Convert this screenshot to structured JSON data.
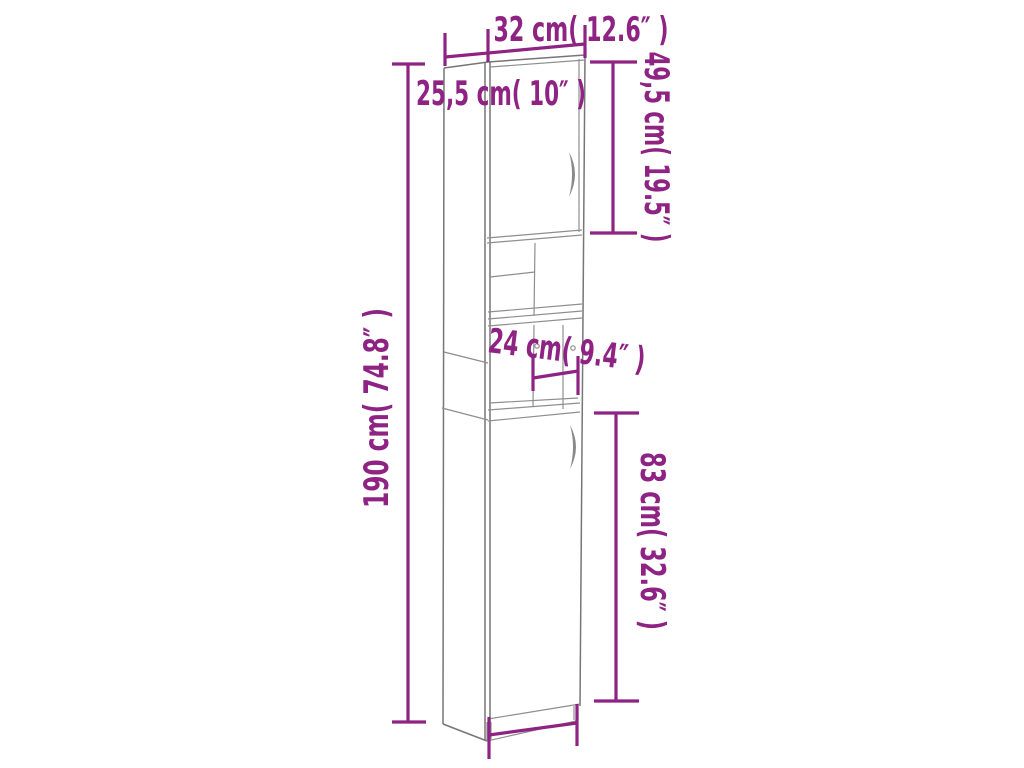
{
  "colors": {
    "dimension": "#8E2383",
    "outline": "#767676",
    "inner": "#8E8E8E",
    "background": "#FFFFFF"
  },
  "diagram": {
    "type": "furniture-dimension-line-drawing",
    "subject": "tall narrow cabinet with two doors and open middle shelves",
    "dimensions": {
      "width_top": "32 cm( 12.6″ )",
      "depth": "25,5 cm( 10″ )",
      "upper_door_height": "49,5 cm( 19.5″ )",
      "total_height": "190 cm( 74.8″ )",
      "niche_width": "24 cm( 9.4″ )",
      "lower_door_height": "83 cm( 32.6″ )",
      "width_bottom": "29 cm( 11.4″ )"
    }
  }
}
